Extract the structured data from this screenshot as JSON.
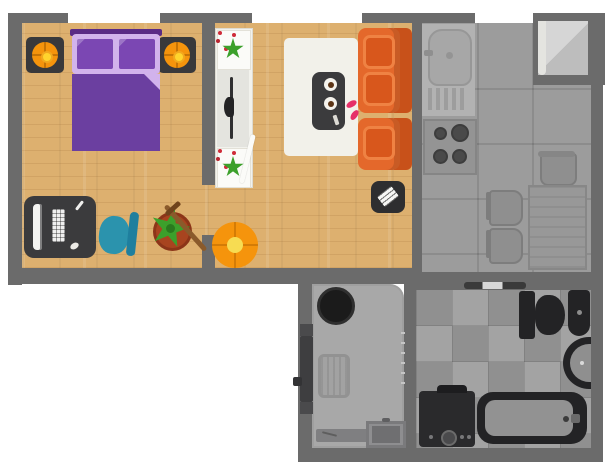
{
  "title": "Apartment Floor Plan",
  "plan": {
    "width_px": 612,
    "height_px": 473
  },
  "colors": {
    "wall": "#6b6b6b",
    "wood": "#ddb06f",
    "kitchen_floor": "#9c9c9c",
    "tile_light": "#a3a3a3",
    "tile_dark": "#909090",
    "hall_floor": "#a8a8a8",
    "fixture_dark": "#232325",
    "appliance_gray": "#8f8f8f",
    "white_unit": "#f2f2ed",
    "rug": "#f2f1ea",
    "bed_purple": "#6b3fa0",
    "bed_dark_purple": "#5a2b85",
    "pillow_light": "#d2b3ec",
    "pillow_dark": "#7b47b3",
    "lamp_orange": "#f5940c",
    "lamp_center": "#ffd42d",
    "nightstand": "#39393b",
    "sofa_base": "#e4682b",
    "sofa_cushion": "#d8571c",
    "sofa_cushion_border": "#ef8243",
    "sofa_back": "#c8511a",
    "slipper_pink": "#e63069",
    "chair_teal": "#2b93ad",
    "chair_teal_dark": "#1f7f9e",
    "plant_green": "#3ca02b",
    "plant_green_dark": "#2a7a1e",
    "pot_terracotta": "#a8441f",
    "broom_brown": "#8a5a2b",
    "desk_dark": "#3b3b3d",
    "door_light": "#d4d4d4"
  },
  "rooms": [
    {
      "name": "Bedroom / Office",
      "furniture": [
        "double bed",
        "nightstand with lamp (left)",
        "nightstand with lamp (right)",
        "desk with monitor, keyboard and mouse",
        "office chair",
        "potted plant",
        "broom"
      ]
    },
    {
      "name": "Living Room",
      "furniture": [
        "tv console with two plants",
        "television",
        "area rug",
        "coffee table with two cups and remote",
        "sofa module (two cushions)",
        "sofa module (one cushion)",
        "slippers",
        "round ottoman",
        "printer on pad",
        "open door"
      ]
    },
    {
      "name": "Kitchen",
      "furniture": [
        "sink with drainboard",
        "four-burner stove",
        "trash bin",
        "dining table",
        "chair (upper)",
        "chair (lower)",
        "open entry door"
      ]
    },
    {
      "name": "Entry Hall",
      "furniture": [
        "round basket",
        "entry door with handle",
        "doormat",
        "bench with pen",
        "side table",
        "folding-door ticks"
      ]
    },
    {
      "name": "Bathroom",
      "furniture": [
        "sliding door threshold",
        "toilet",
        "wall-mounted sink",
        "round corner sink",
        "bathtub with faucet",
        "washing machine"
      ]
    }
  ]
}
